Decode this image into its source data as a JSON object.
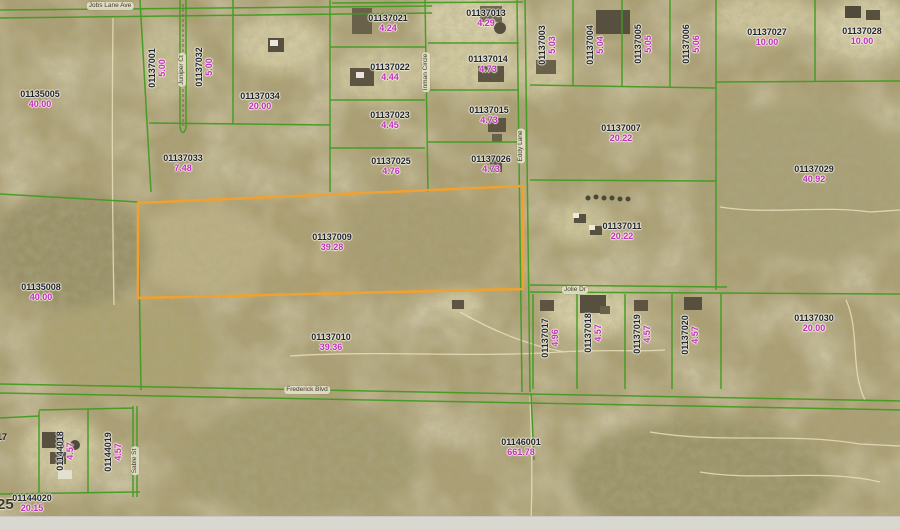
{
  "map": {
    "selected_parcel": {
      "id": "01137009",
      "acres": "39.28"
    },
    "colors": {
      "boundary_green": "#3f9b1e",
      "selected_orange": "#efa231",
      "parcel_id": "#1f2433",
      "acreage": "#c22ec2",
      "road_label_text": "#3f3d33",
      "road_label_bg": "rgba(233,227,204,0.85)"
    },
    "parcels": [
      {
        "id": "01135005",
        "acres": "40.00",
        "x": 40,
        "y": 100,
        "vertical": false,
        "selected": false
      },
      {
        "id": "01137001",
        "acres": "5.00",
        "x": 158,
        "y": 68,
        "vertical": true,
        "selected": false
      },
      {
        "id": "01137032",
        "acres": "5.00",
        "x": 205,
        "y": 67,
        "vertical": true,
        "selected": false
      },
      {
        "id": "01137034",
        "acres": "20.00",
        "x": 260,
        "y": 102,
        "vertical": false,
        "selected": false
      },
      {
        "id": "01137033",
        "acres": "7.48",
        "x": 183,
        "y": 164,
        "vertical": false,
        "selected": false
      },
      {
        "id": "01137021",
        "acres": "4.24",
        "x": 388,
        "y": 24,
        "vertical": false,
        "selected": false
      },
      {
        "id": "01137022",
        "acres": "4.44",
        "x": 390,
        "y": 73,
        "vertical": false,
        "selected": false
      },
      {
        "id": "01137023",
        "acres": "4.45",
        "x": 390,
        "y": 121,
        "vertical": false,
        "selected": false
      },
      {
        "id": "01137025",
        "acres": "4.76",
        "x": 391,
        "y": 167,
        "vertical": false,
        "selected": false
      },
      {
        "id": "01137013",
        "acres": "4.29",
        "x": 486,
        "y": 19,
        "vertical": false,
        "selected": false
      },
      {
        "id": "01137014",
        "acres": "4.73",
        "x": 488,
        "y": 65,
        "vertical": false,
        "selected": false
      },
      {
        "id": "01137015",
        "acres": "4.73",
        "x": 489,
        "y": 116,
        "vertical": false,
        "selected": false
      },
      {
        "id": "01137026",
        "acres": "4.73",
        "x": 491,
        "y": 165,
        "vertical": false,
        "selected": false
      },
      {
        "id": "01137003",
        "acres": "5.03",
        "x": 548,
        "y": 45,
        "vertical": true,
        "selected": false
      },
      {
        "id": "01137004",
        "acres": "5.04",
        "x": 596,
        "y": 45,
        "vertical": true,
        "selected": false
      },
      {
        "id": "01137005",
        "acres": "5.05",
        "x": 644,
        "y": 44,
        "vertical": true,
        "selected": false
      },
      {
        "id": "01137006",
        "acres": "5.06",
        "x": 692,
        "y": 44,
        "vertical": true,
        "selected": false
      },
      {
        "id": "01137027",
        "acres": "10.00",
        "x": 767,
        "y": 38,
        "vertical": false,
        "selected": false
      },
      {
        "id": "01137028",
        "acres": "10.00",
        "x": 862,
        "y": 37,
        "vertical": false,
        "selected": false
      },
      {
        "id": "01137007",
        "acres": "20.22",
        "x": 621,
        "y": 134,
        "vertical": false,
        "selected": false
      },
      {
        "id": "01137029",
        "acres": "40.92",
        "x": 814,
        "y": 175,
        "vertical": false,
        "selected": false
      },
      {
        "id": "01137011",
        "acres": "20.22",
        "x": 622,
        "y": 232,
        "vertical": false,
        "selected": false
      },
      {
        "id": "01137009",
        "acres": "39.28",
        "x": 332,
        "y": 243,
        "vertical": false,
        "selected": true
      },
      {
        "id": "01135008",
        "acres": "40.00",
        "x": 41,
        "y": 293,
        "vertical": false,
        "selected": false
      },
      {
        "id": "01137010",
        "acres": "39.36",
        "x": 331,
        "y": 343,
        "vertical": false,
        "selected": false
      },
      {
        "id": "01137017",
        "acres": "4.96",
        "x": 551,
        "y": 338,
        "vertical": true,
        "selected": false
      },
      {
        "id": "01137018",
        "acres": "4.57",
        "x": 594,
        "y": 333,
        "vertical": true,
        "selected": false
      },
      {
        "id": "01137019",
        "acres": "4.57",
        "x": 643,
        "y": 334,
        "vertical": true,
        "selected": false
      },
      {
        "id": "01137020",
        "acres": "4.57",
        "x": 691,
        "y": 335,
        "vertical": true,
        "selected": false
      },
      {
        "id": "01137030",
        "acres": "20.00",
        "x": 814,
        "y": 324,
        "vertical": false,
        "selected": false
      },
      {
        "id": "01146001",
        "acres": "661.78",
        "x": 521,
        "y": 448,
        "vertical": false,
        "selected": false
      },
      {
        "id": "01144018",
        "acres": "4.57",
        "x": 66,
        "y": 451,
        "vertical": true,
        "selected": false
      },
      {
        "id": "01144019",
        "acres": "4.57",
        "x": 114,
        "y": 452,
        "vertical": true,
        "selected": false
      },
      {
        "id": "01144020",
        "acres": "20.15",
        "x": 32,
        "y": 504,
        "vertical": false,
        "selected": false
      }
    ],
    "roads": [
      {
        "name": "Jobs Lane Ave",
        "x": 110,
        "y": 6,
        "vertical": false
      },
      {
        "name": "Juniper Ct",
        "x": 182,
        "y": 70,
        "vertical": true
      },
      {
        "name": "Inman Circle",
        "x": 426,
        "y": 72,
        "vertical": true
      },
      {
        "name": "Eddy Lane",
        "x": 521,
        "y": 146,
        "vertical": true
      },
      {
        "name": "Jolie Dr",
        "x": 575,
        "y": 290,
        "vertical": false
      },
      {
        "name": "Frederick Blvd",
        "x": 307,
        "y": 390,
        "vertical": false
      },
      {
        "name": "Sable St",
        "x": 135,
        "y": 461,
        "vertical": true
      }
    ],
    "section_number": "25",
    "cutoff_label": "17"
  }
}
